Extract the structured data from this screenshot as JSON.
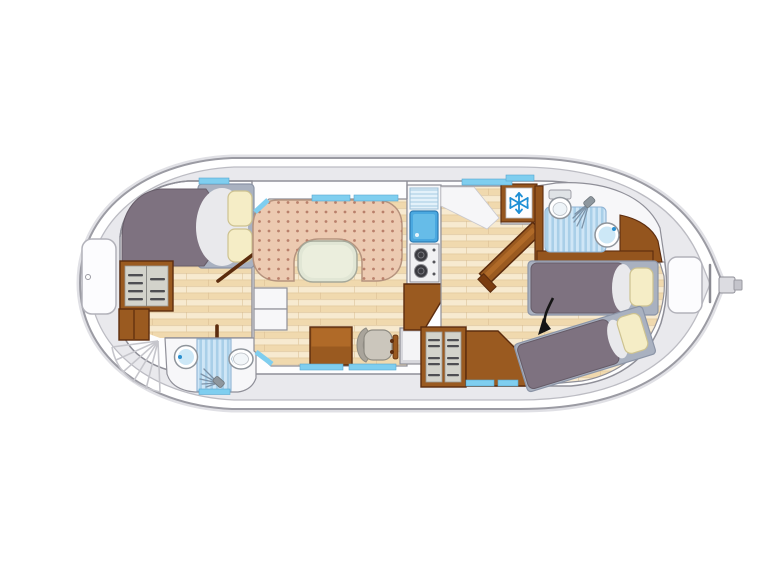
{
  "meta": {
    "depicts": "top-view boat deck floor plan"
  },
  "icons": {
    "snowflake": "snowflake-fridge-symbol",
    "shower_head": "shower-spray-symbol",
    "direction_arrow": "curved-black-arrow",
    "bow_hatch_handle": "small-circle-handle"
  },
  "colors": {
    "page-bg": "#ffffff",
    "hull-line": "#9b9ba3",
    "hull-shadow": "#e0e0e5",
    "deck": "#e9e9ed",
    "deck-line": "#bcbcc3",
    "wall": "#8f8f98",
    "cabin": "#fdfdfe",
    "wood1": "#f7ead0",
    "wood2": "#f0d9ae",
    "seam": "#d8bc90",
    "sofa": "#eccab1",
    "sofa-dot": "#b9806b",
    "sofa-line": "#b5937e",
    "table": "#e1e6d5",
    "table-line": "#a5a89a",
    "bed": "#7e7280",
    "bed-line": "#665c68",
    "bed-frame": "#a9b1c0",
    "bed-frame-line": "#8b94a6",
    "pillow": "#f5edc6",
    "pillow-line": "#cdc290",
    "fold": "#e9e9ec",
    "wood-furn": "#9a5a20",
    "wood-furn-light": "#b06a28",
    "wood-edge": "#5c2c0e",
    "wood-wall": "#94551e",
    "panel": "#d3d3cb",
    "panel-stripe": "#4e4e52",
    "window": "#7fceef",
    "window-line": "#58a8cf",
    "water": "#4aa8e0",
    "water-deep": "#2d7bb2",
    "water-light": "#66bce8",
    "shower1": "#cfe6f6",
    "shower2": "#a9cfe8",
    "shower-line": "#8fb3d4",
    "fixture": "#ffffff",
    "fixture-line": "#8f959c",
    "fixture-fill": "#cde8f7",
    "stove": "#f1f1f3",
    "burner": "#3b3b41",
    "seat": "#cbc6bc",
    "seat-back": "#a9a49b",
    "seat-line": "#8e8b82",
    "snowflake": "#1e8fd5",
    "arrow": "#151515",
    "steel": "#dcdce1"
  }
}
